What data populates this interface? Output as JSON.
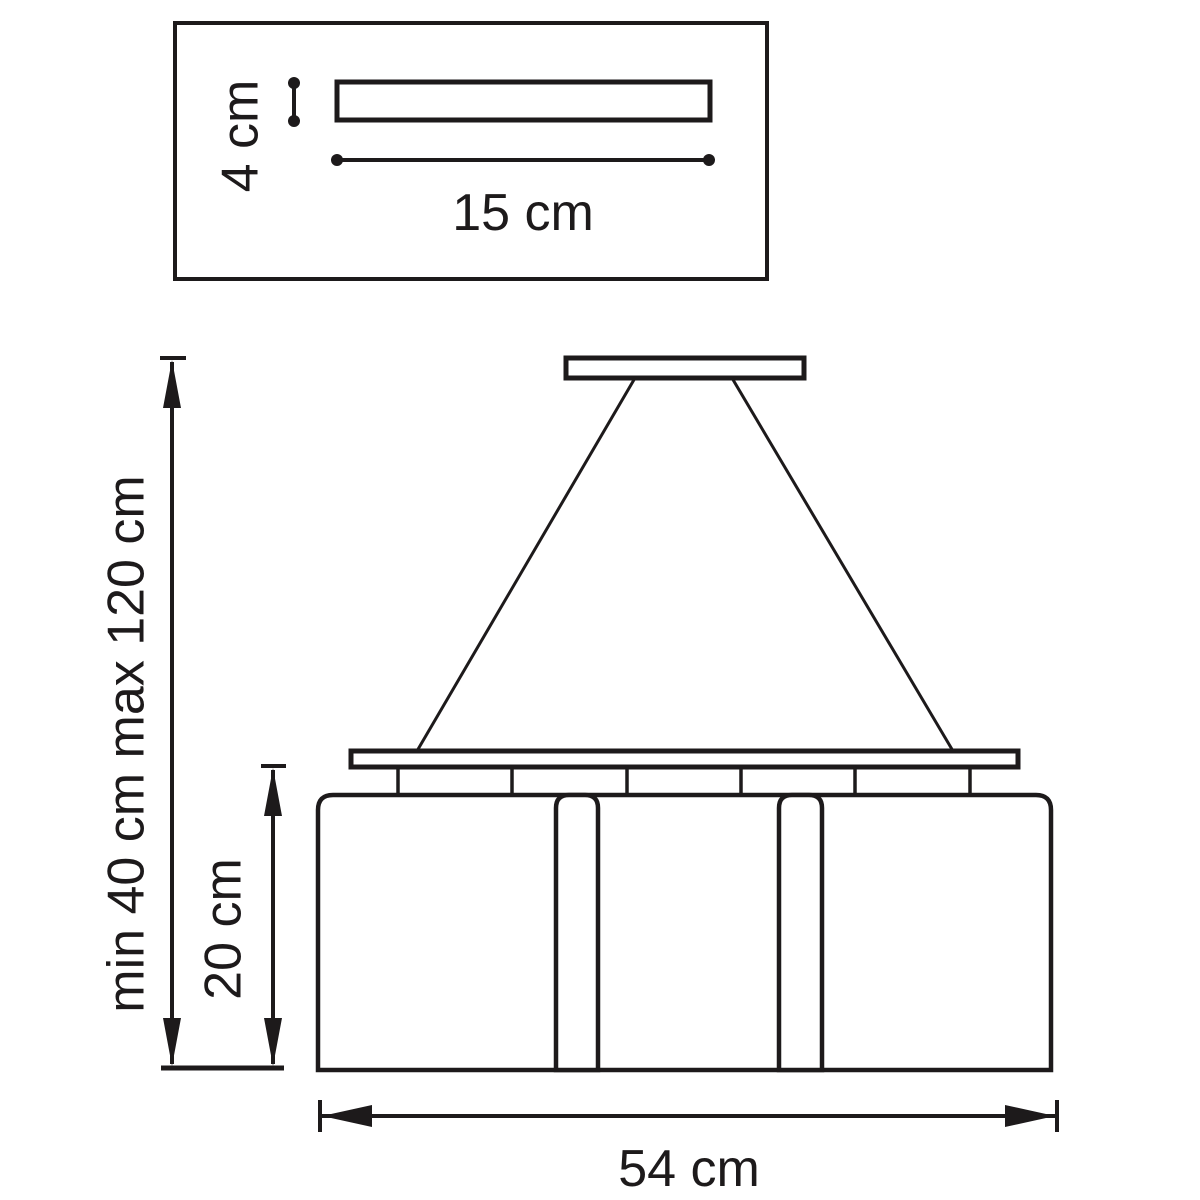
{
  "diagram": {
    "kind": "technical-dimension-drawing",
    "subject": "pendant lamp with three shades, ceiling canopy detail inset",
    "colors": {
      "background": "#ffffff",
      "line": "#1d1a1b"
    },
    "labels": {
      "canopy_height": "4 cm",
      "canopy_width": "15 cm",
      "suspension_height": "min 40 cm max 120 cm",
      "shade_height": "20 cm",
      "fixture_width": "54 cm"
    }
  }
}
